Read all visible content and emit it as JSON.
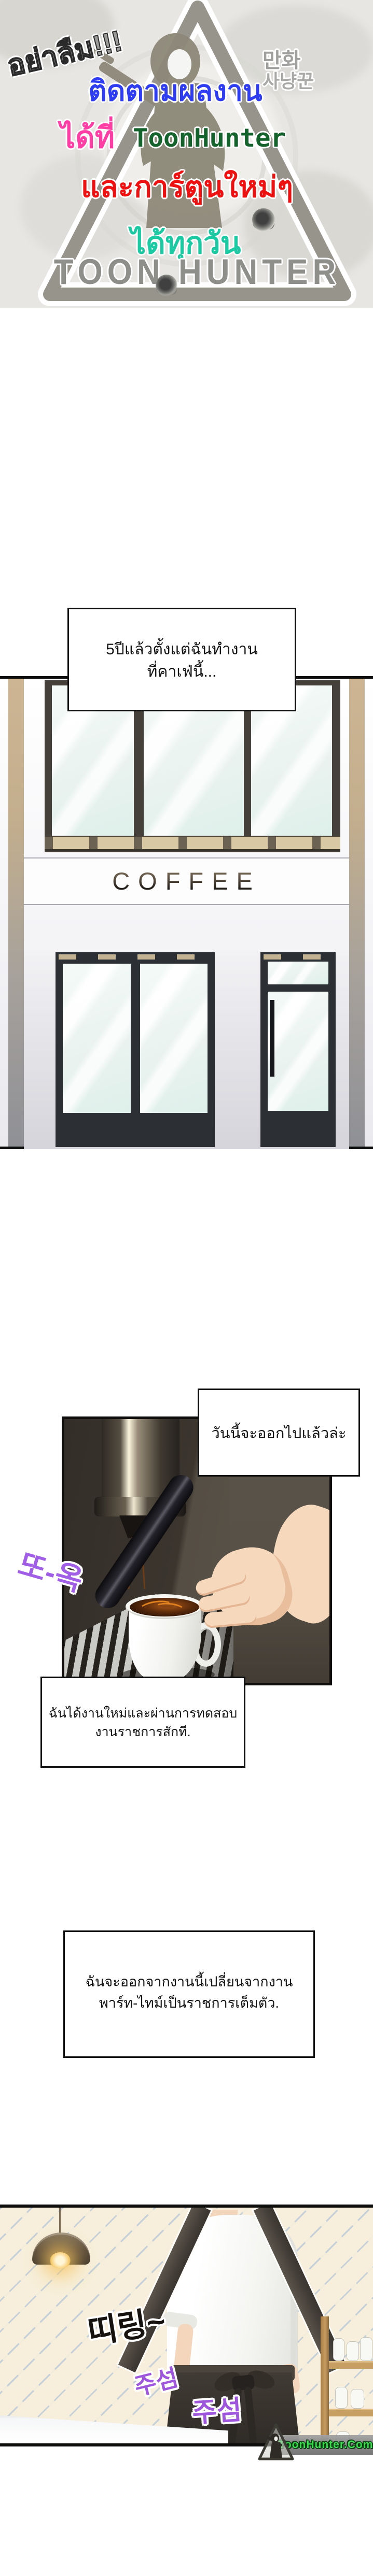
{
  "banner": {
    "reminder": "อย่าลืม!!!",
    "follow_line": "ติดตามผลงาน",
    "at_prefix": "ได้ที่",
    "brand": "ToonHunter",
    "new_cartoons_line": "และการ์ตูนใหม่ๆ",
    "everyday_line": "ได้ทุกวัน",
    "korean_top": "만화",
    "korean_bottom": "사냥꾼",
    "logo_text": "TOON HUNTER",
    "colors": {
      "reminder": "#9b9b99",
      "follow": "#2f3df2",
      "at": "#ff3ea5",
      "brand": "#15632c",
      "new_cartoons": "#ee1111",
      "everyday": "#1bc9a2",
      "logo": "#8e8e8b"
    }
  },
  "dialogue": {
    "box1": {
      "line1": "5ปีแล้วตั้งแต่ฉันทำงาน",
      "line2": "ที่คาเฟ่นี้..."
    },
    "box2": {
      "line1": "วันนี้จะออกไปแล้วล่ะ"
    },
    "box3": {
      "line1": "ฉันได้งานใหม่และผ่านการทดสอบ",
      "line2": "งานราชการสักที."
    },
    "box4": {
      "line1": "ฉันจะออกจากงานนี้เปลี่ยนจากงาน",
      "line2": "พาร์ท-ไทม์เป็นราชการเต็มตัว."
    }
  },
  "storefront": {
    "sign": "COFFEE"
  },
  "sfx": {
    "drip": {
      "text": "또-옥",
      "color": "#a05fe6"
    },
    "chime": {
      "text": "띠링~",
      "color": "#161210"
    },
    "rustle1": {
      "text": "주섬",
      "color": "#9e56dd"
    },
    "rustle2": {
      "text": "주섬",
      "color": "#9e56dd"
    }
  },
  "watermark": {
    "text": "ToonHunter.Com",
    "color": "#38e44e"
  }
}
